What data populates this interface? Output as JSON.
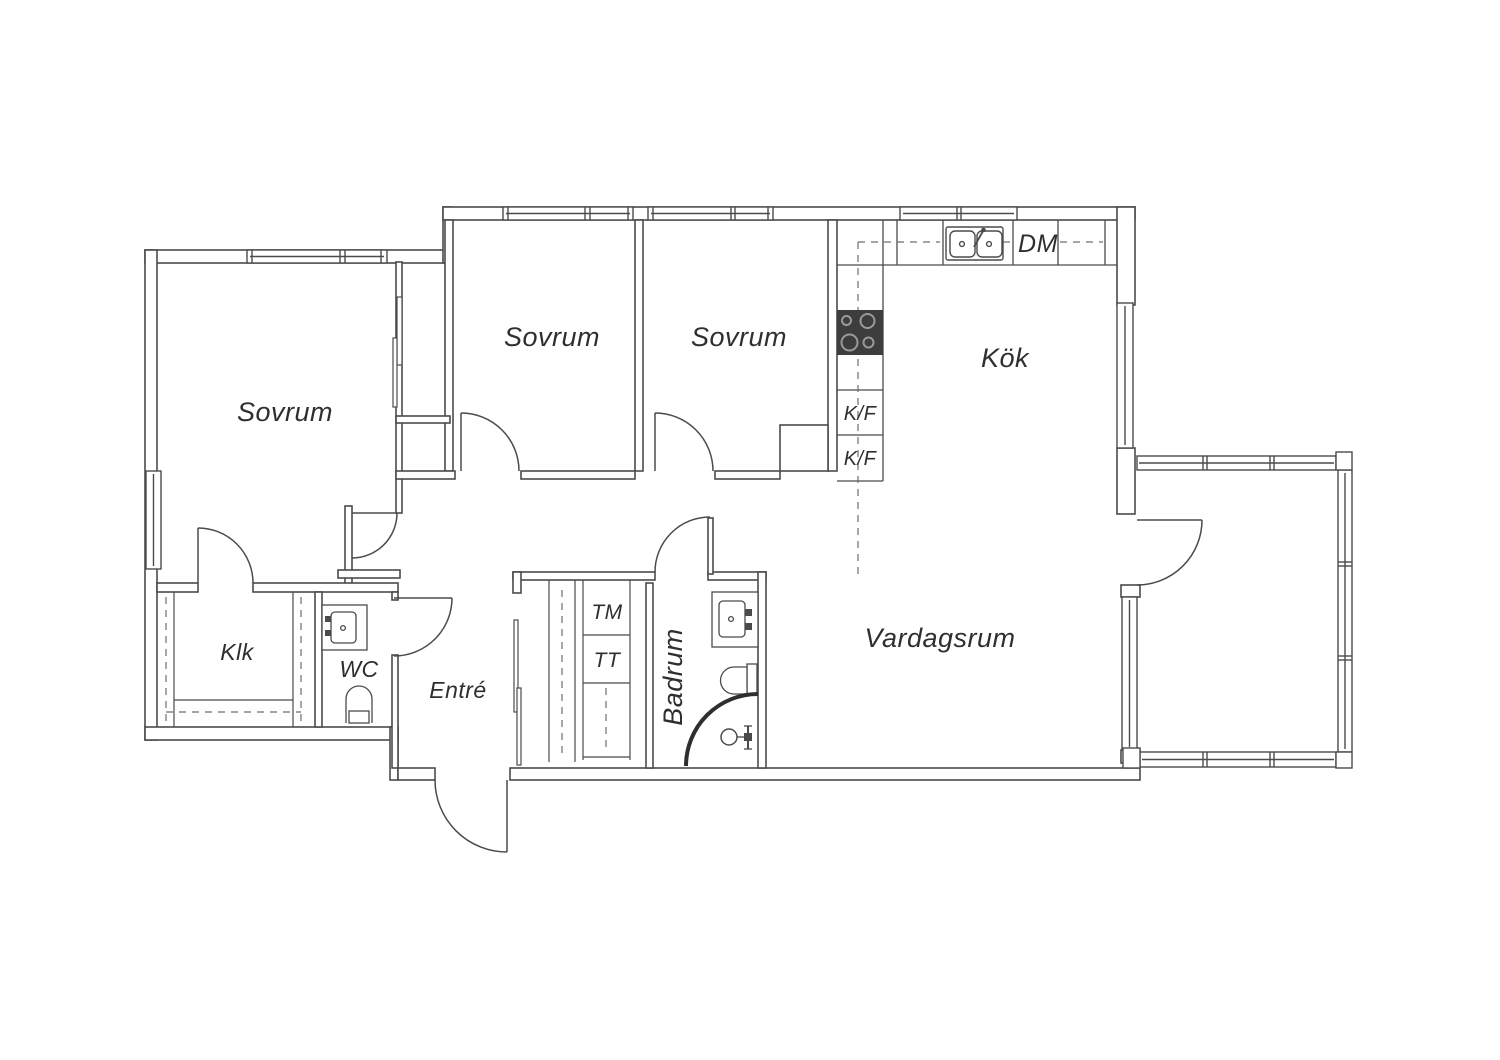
{
  "title": "Apartment floor plan",
  "colors": {
    "wall": "#4b4b4b",
    "text": "#2f2f2f",
    "stove": "#3d3d3d",
    "burner": "#9a9a9a",
    "dashed": "#6f6f6f",
    "shower": "#2e2e2e"
  },
  "rooms": {
    "sovrum_left": {
      "label": "Sovrum"
    },
    "sovrum_mid": {
      "label": "Sovrum"
    },
    "sovrum_right": {
      "label": "Sovrum"
    },
    "kok": {
      "label": "Kök"
    },
    "vardagsrum": {
      "label": "Vardagsrum"
    },
    "klk": {
      "label": "Klk"
    },
    "wc": {
      "label": "WC"
    },
    "entre": {
      "label": "Entré"
    },
    "badrum": {
      "label": "Badrum"
    }
  },
  "appliances": {
    "dm": {
      "label": "DM"
    },
    "tm": {
      "label": "TM"
    },
    "tt": {
      "label": "TT"
    },
    "kf_upper": {
      "label": "K/F"
    },
    "kf_lower": {
      "label": "K/F"
    }
  }
}
